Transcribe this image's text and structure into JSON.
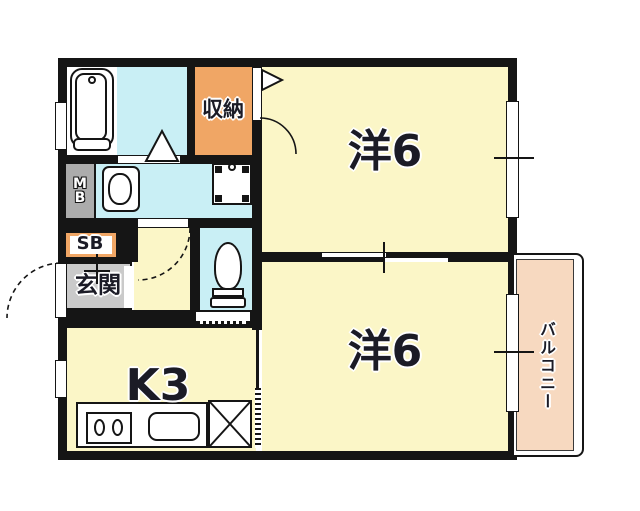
{
  "floorplan": {
    "rooms": {
      "western_room_upper": {
        "label": "洋6"
      },
      "western_room_lower": {
        "label": "洋6"
      },
      "kitchen": {
        "label": "K3"
      },
      "entrance": {
        "label": "玄関"
      },
      "closet": {
        "label": "収納"
      },
      "balcony": {
        "label": "バルコニー"
      },
      "meter_box": {
        "label": "MB"
      },
      "shoe_box": {
        "label": "SB"
      }
    },
    "colors": {
      "room_fill": "#FBF6C7",
      "wet_area_fill": "#C9EFF5",
      "closet_fill": "#F0A665",
      "balcony_fill": "#F7D9C0",
      "entrance_fill": "#CACACA",
      "meter_box_fill": "#ACACAC",
      "wall": "#151515"
    },
    "fixtures": [
      "bathtub",
      "washbasin",
      "washing-machine-pan",
      "toilet",
      "gas-stove-2-burner",
      "kitchen-sink",
      "refrigerator-space-x",
      "sliding-partition",
      "door-swing-arcs",
      "windows"
    ]
  }
}
